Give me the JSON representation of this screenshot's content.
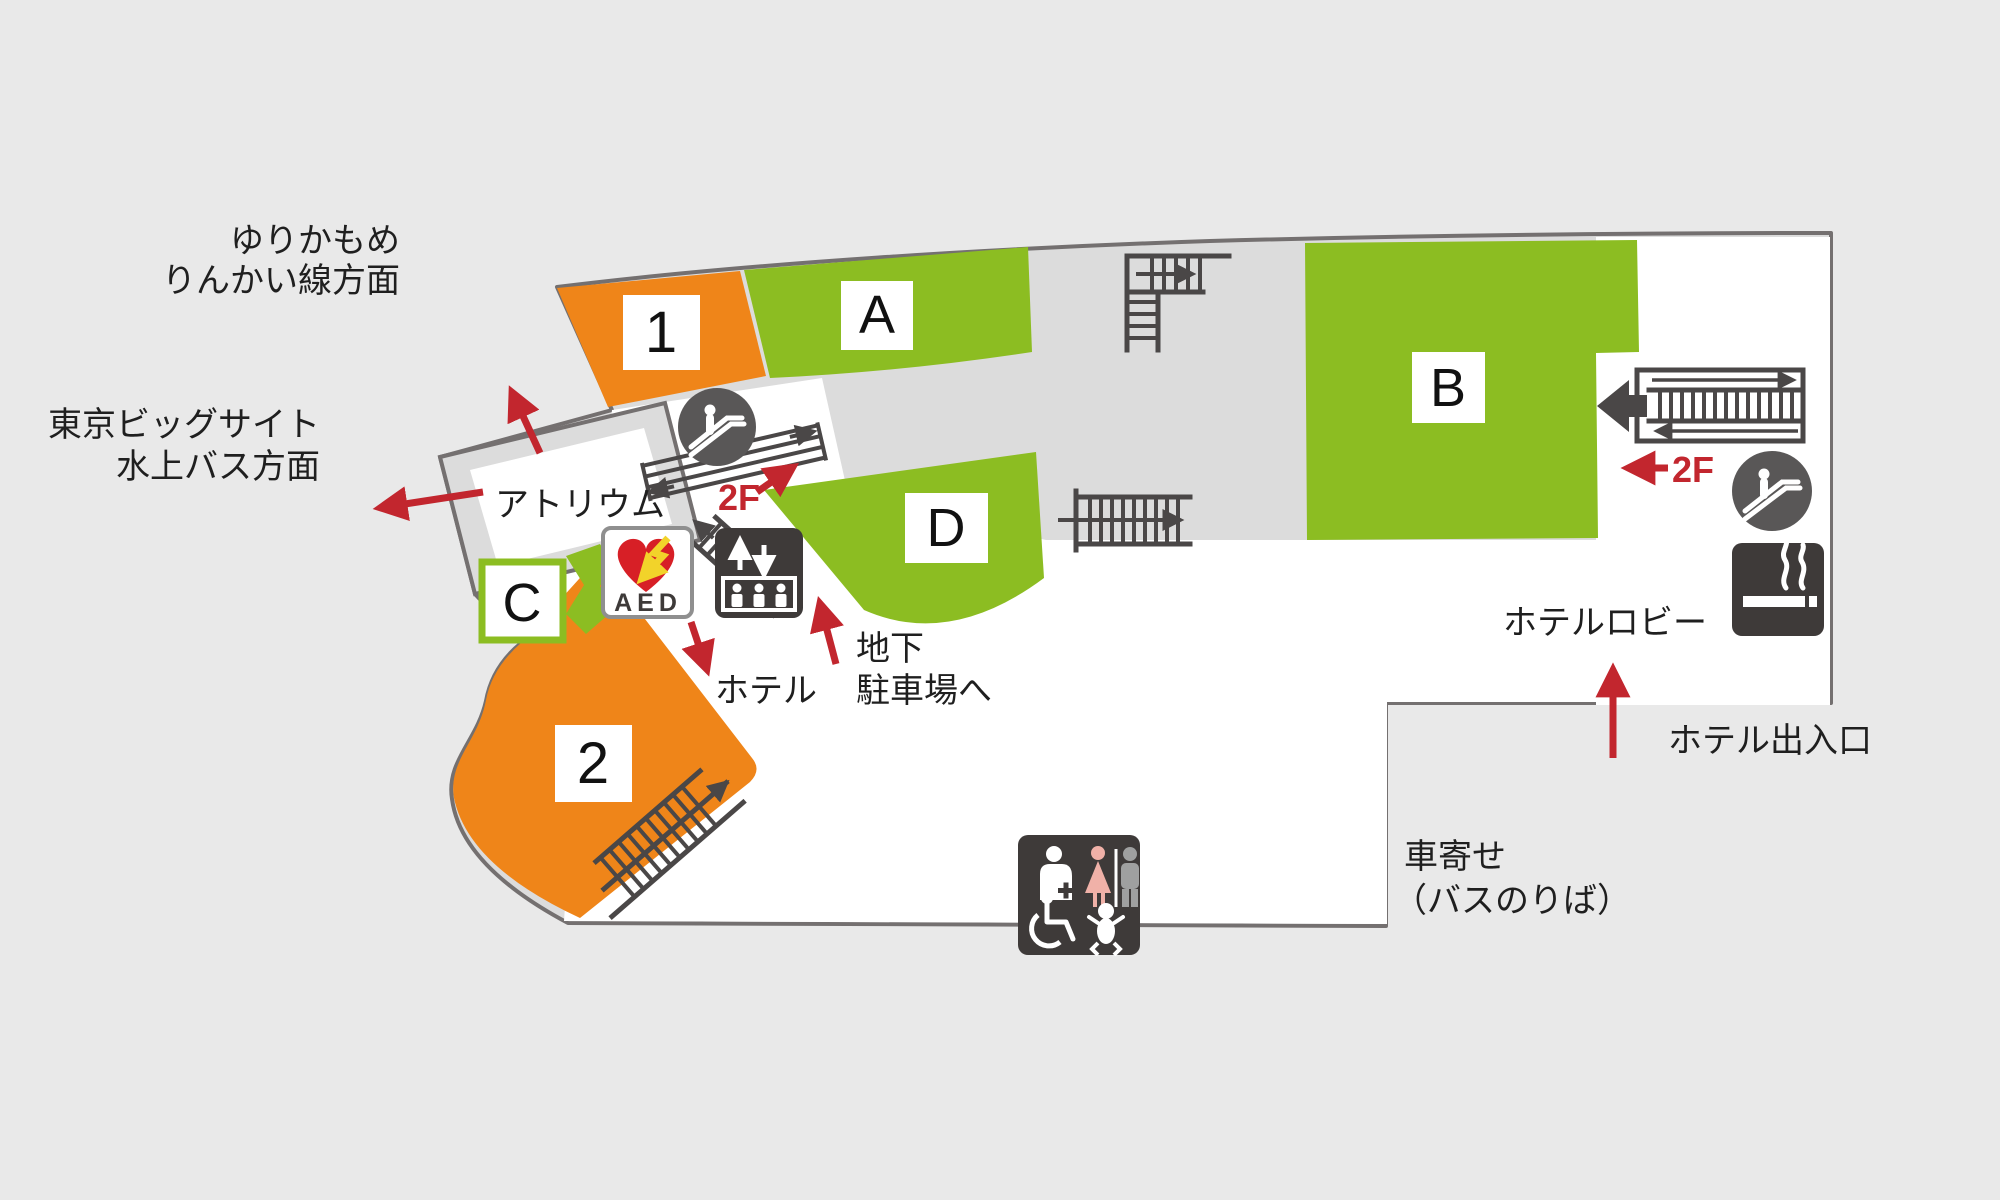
{
  "colors": {
    "orange": "#ef8519",
    "green": "#8cbd22",
    "red": "#c2262e",
    "dark": "#4a4747",
    "panel_dark": "#3e3a39",
    "floor_gray": "#dcdcdc",
    "background": "#e9e9e9",
    "outline": "#747070"
  },
  "directions": {
    "yurikamome_line1": "ゆりかもめ",
    "yurikamome_line2": "りんかい線方面",
    "bigsight_line1": "東京ビッグサイト",
    "bigsight_line2": "水上バス方面"
  },
  "areas": {
    "atrium": "アトリウム",
    "hotel": "ホテル",
    "hotel_lobby": "ホテルロビー",
    "hotel_entrance": "ホテル出入口",
    "basement_line1": "地下",
    "basement_line2": "駐車場へ",
    "pickup_line1": "車寄せ",
    "pickup_line2": "（バスのりば）"
  },
  "floor_links": {
    "to_2f_center": "2F",
    "to_2f_right": "2F"
  },
  "halls": [
    {
      "label": "1"
    },
    {
      "label": "A"
    },
    {
      "label": "B"
    },
    {
      "label": "C"
    },
    {
      "label": "D"
    },
    {
      "label": "2"
    }
  ],
  "signs": {
    "aed": "AED"
  },
  "icons": [
    "escalator-icon",
    "stairs-icon",
    "elevator-icon",
    "aed-icon",
    "smoking-area-icon",
    "restroom-icon",
    "wheelchair-icon",
    "baby-care-icon"
  ]
}
